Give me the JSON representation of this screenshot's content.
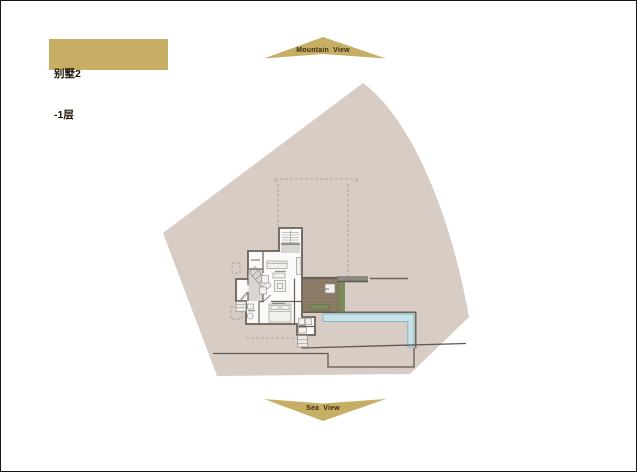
{
  "window": {
    "width": 637,
    "height": 472
  },
  "title_card": {
    "line1": "别墅2",
    "line2": "-1层"
  },
  "orientation": {
    "top_label": "Mountain View",
    "bottom_label": "Sea View"
  },
  "colors": {
    "gold": "#c7ae65",
    "marker_text": "#3b2c10",
    "site_fill": "#d7cdc5",
    "wall": "#696259",
    "room_fill": "#fbfaf8",
    "hall_fill": "#d9d6d2",
    "deck_wood": "#8e7e6a",
    "plank_line": "#5c4c3a",
    "planter_green": "#7d8a5c",
    "planter_edge": "#5a673f",
    "pool_water": "#c6e3ea",
    "pool_edge": "#8ab4bd",
    "ground_line": "#5f5952",
    "dashed_line": "#a39d95",
    "furniture_fill": "#f2f1ee",
    "furniture_stroke": "#8d8781",
    "label_mark": "#8a857e",
    "band_gray": "#8f8981"
  },
  "plan": {
    "type": "villa-basement-floor-plan",
    "elements": [
      "site-boundary",
      "upper-floor-dashed-outline",
      "stair-core",
      "diagonal-staircase",
      "storage-room",
      "entry-porch",
      "living-room",
      "bedroom",
      "bathroom",
      "utility-room",
      "wood-deck",
      "deck-table",
      "planters",
      "infinity-pool",
      "terrace",
      "ground-retaining-walls"
    ]
  }
}
